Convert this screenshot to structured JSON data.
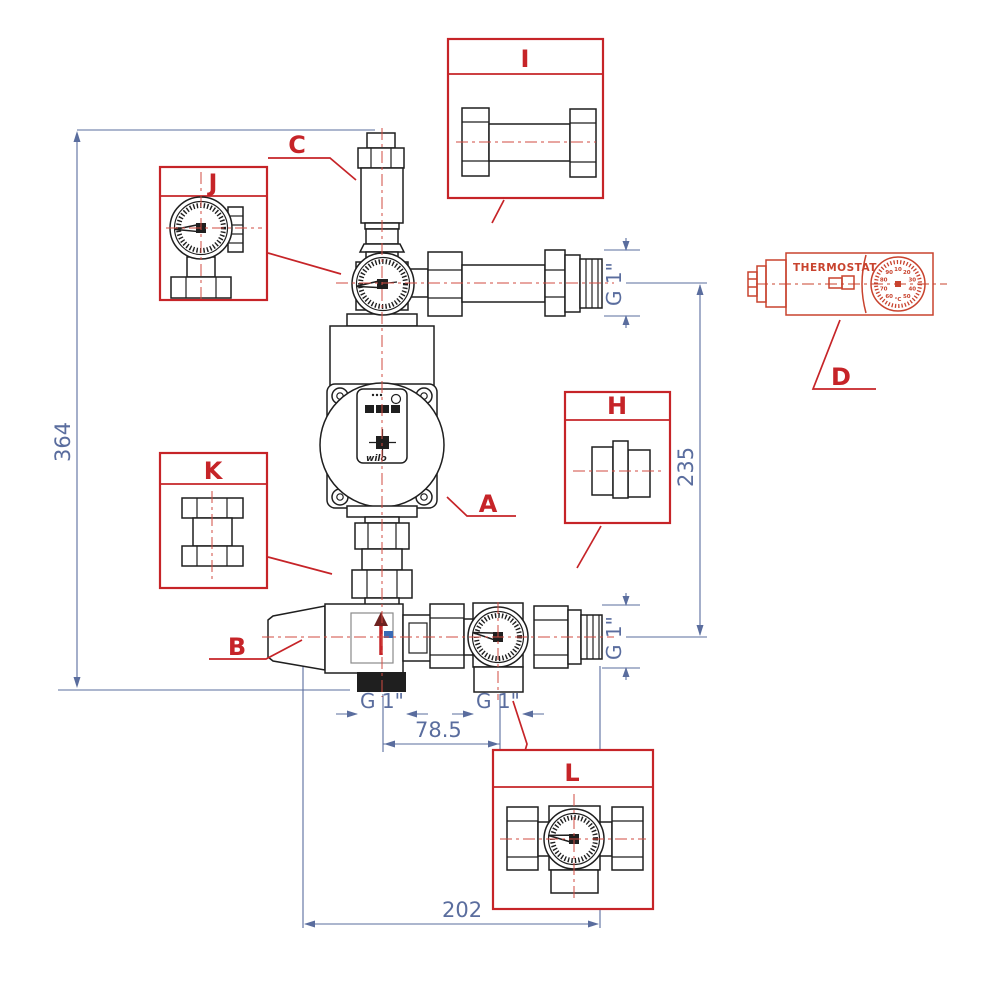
{
  "colors": {
    "drawing_line": "#1f1f1f",
    "callout_red": "#c62428",
    "centerline_red": "#d14b42",
    "dimension_blue": "#5a6d9e",
    "thermostat_red": "#c8432e",
    "background": "#ffffff"
  },
  "callout_labels": {
    "a": "A",
    "b": "B",
    "c": "C",
    "d": "D",
    "h": "H",
    "i": "I",
    "j": "J",
    "k": "K",
    "l": "L"
  },
  "dimensions": {
    "overall_height": "364",
    "height_between_pipes": "235",
    "overall_width": "202",
    "port_spacing": "78.5",
    "thread_top_right": "G 1\"",
    "thread_bottom_right": "G 1\"",
    "thread_port_left": "G 1\"",
    "thread_port_right": "G 1\""
  },
  "thermostat": {
    "label": "THERMOSTAT",
    "dial_marks": [
      "10",
      "20",
      "30",
      "40",
      "50",
      "°C",
      "60",
      "70",
      "80",
      "90"
    ]
  },
  "pump": {
    "brand": "wilo"
  }
}
